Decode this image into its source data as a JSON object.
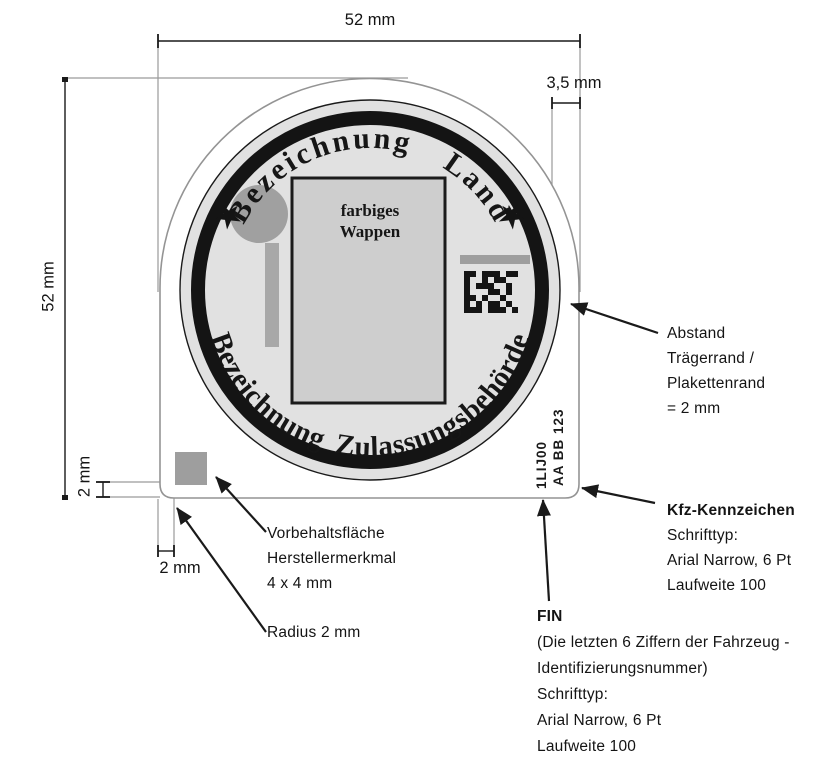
{
  "dimensions": {
    "top_width": "52 mm",
    "left_height": "52 mm",
    "plakette_offset": "3,5 mm",
    "edge_gap_vertical": "2 mm",
    "edge_gap_horizontal": "2 mm"
  },
  "plakette": {
    "top_arc_text": "Bezeichnung Land",
    "bottom_arc_text": "Bezeichnung Zulassungsbehörde",
    "left_star": "★",
    "right_star": "★",
    "wappen": {
      "line1": "farbiges",
      "line2": "Wappen"
    },
    "fin_text": "1LIJ00",
    "kennzeichen_text": "AA BB 123"
  },
  "annotations": {
    "abstand": {
      "lines": [
        "Abstand",
        "Trägerrand /",
        "Plakettenrand",
        "= 2 mm"
      ]
    },
    "kfz": {
      "title": "Kfz-Kennzeichen",
      "lines": [
        "Schrifttyp:",
        "Arial Narrow, 6 Pt",
        "Laufweite 100"
      ]
    },
    "fin": {
      "title": "FIN",
      "lines": [
        "(Die letzten 6 Ziffern der Fahrzeug -",
        "Identifizierungsnummer)",
        "Schrifttyp:",
        "Arial Narrow, 6 Pt",
        "Laufweite 100"
      ]
    },
    "vorbehaltsflaeche": {
      "lines": [
        "Vorbehaltsfläche",
        "Herstellermerkmal",
        "4 x 4 mm"
      ]
    },
    "radius": {
      "label": "Radius 2 mm"
    }
  },
  "colors": {
    "line": "#1a1a1a",
    "badge_outline": "#949494",
    "seal_fill": "#e1e1e1",
    "ring": "#141414",
    "wappen_fill": "#cecece",
    "decoration_gray": "#a0a0a0",
    "bar_gray": "#a8a8a8"
  },
  "data_matrix": {
    "name": "data-matrix-code",
    "cell": 6,
    "origin_x": 464,
    "origin_y": 271,
    "pattern": [
      "110111011",
      "100101100",
      "101110010",
      "100011010",
      "110100100",
      "101011010",
      "111011101"
    ]
  }
}
